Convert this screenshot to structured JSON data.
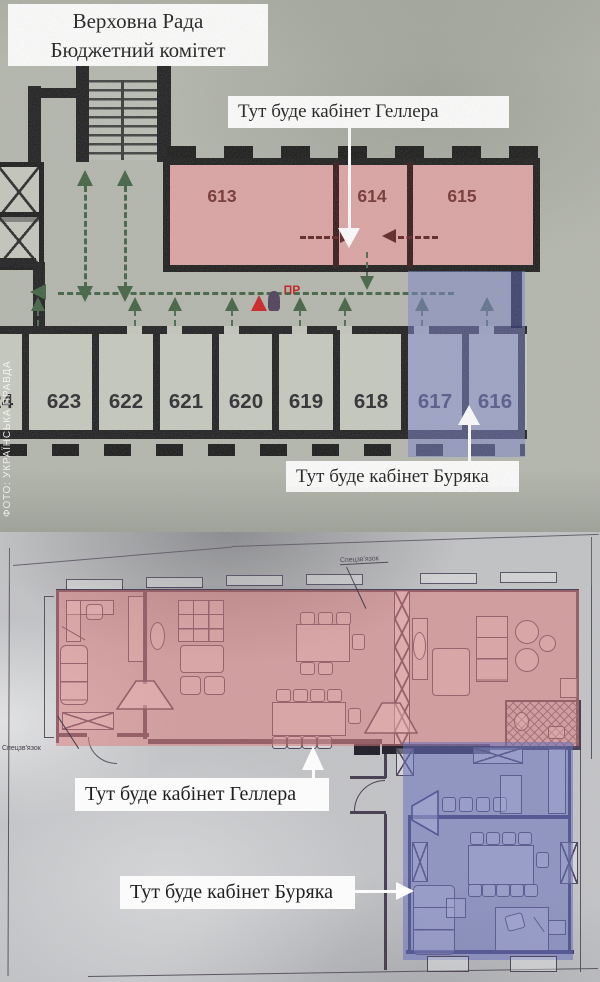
{
  "photo_top": {
    "title_line1": "Верховна Рада",
    "title_line2": "Бюджетний комітет",
    "label_geller": "Тут буде кабінет Геллера",
    "label_buryak": "Тут буде кабінет Буряка",
    "watermark": "ФОТО: УКРАЇНСЬКА ПРАВДА",
    "rooms_top": [
      "613",
      "614",
      "615"
    ],
    "rooms_bottom": [
      "624",
      "623",
      "622",
      "621",
      "620",
      "619",
      "618",
      "617",
      "616"
    ],
    "fire_point_label": "ПР"
  },
  "photo_bottom": {
    "label_geller": "Тут буде кабінет Геллера",
    "label_buryak": "Тут буде кабінет Буряка",
    "note_top": "Спецзв'язок",
    "note_left": "Спецзв'язок"
  },
  "colors": {
    "geller_zone_top": "#dca2a2",
    "buryak_zone_top": "#767fc8",
    "geller_zone_bottom": "#de7878",
    "buryak_zone_bottom": "#646ebe",
    "route_green": "#3d5e3e",
    "wall_black": "#19181a",
    "fire_red": "#c01515"
  }
}
